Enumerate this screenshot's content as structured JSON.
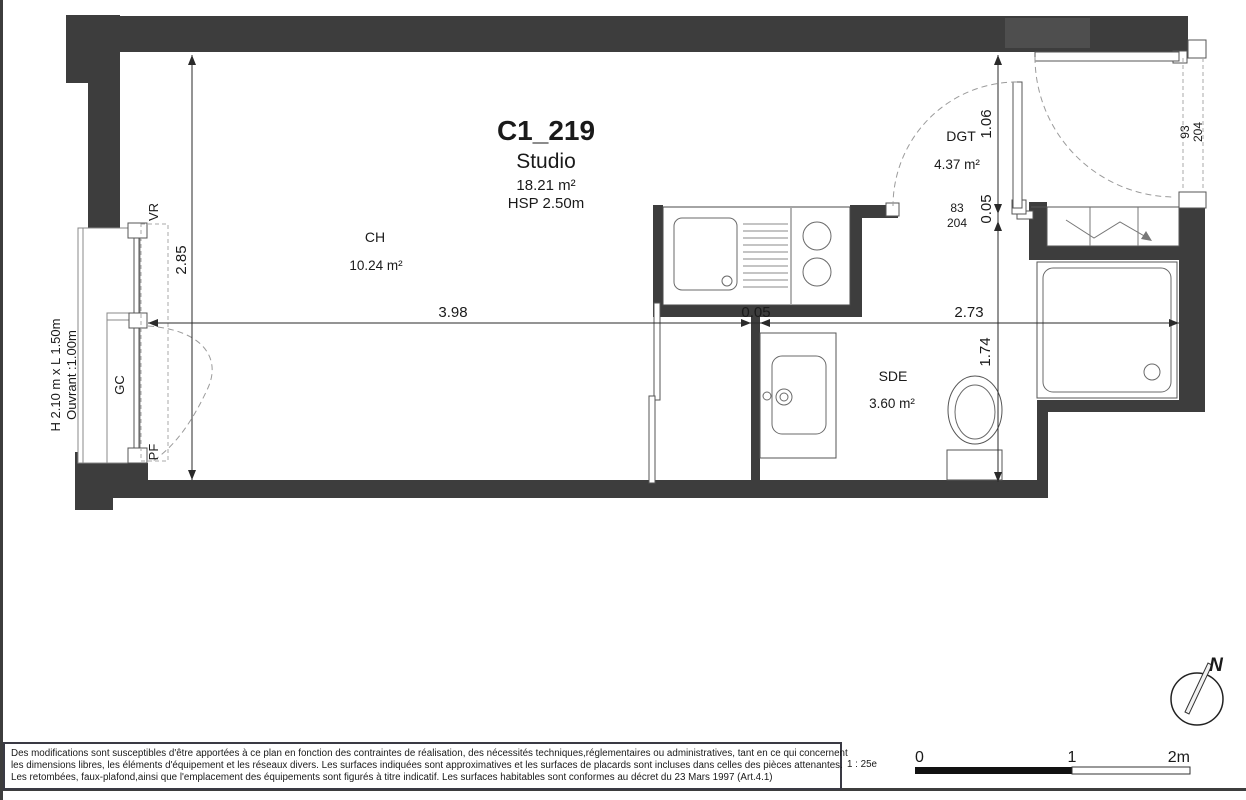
{
  "colors": {
    "wall": "#3d3d3d",
    "furniture_line": "#555555",
    "dashed_line": "#9b9b9b",
    "text": "#1a1a1a",
    "frame": "#3a3a44"
  },
  "title_block": {
    "unit": "C1_219",
    "type": "Studio",
    "area": "18.21 m²",
    "ceiling": "HSP 2.50m"
  },
  "rooms": {
    "ch": {
      "code": "CH",
      "area": "10.24 m²"
    },
    "dgt": {
      "code": "DGT",
      "area": "4.37 m²"
    },
    "sde": {
      "code": "SDE",
      "area": "3.60 m²"
    }
  },
  "dimensions": {
    "room_height": "2.85",
    "ch_width": "3.98",
    "partition_thickness": "0.05",
    "right_width": "2.73",
    "dgt_depth": "1.06",
    "dgt_wall_thickness": "0.05",
    "sde_depth": "1.74"
  },
  "doors": {
    "dgt_width": "83",
    "dgt_height": "204",
    "entry_width": "93",
    "entry_height": "204"
  },
  "window": {
    "size": "H 2.10 m x L 1.50m",
    "opening": "Ouvrant :1.00m",
    "shutter": "VR",
    "guardrail": "GC",
    "french_door": "PF"
  },
  "footer": {
    "disclaimer": [
      "Des modifications sont susceptibles d'être apportées à ce plan en fonction des contraintes de réalisation, des nécessités techniques,réglementaires ou administratives, tant en ce qui concernent",
      "les dimensions libres, les éléments d'équipement et les réseaux divers. Les surfaces indiquées sont approximatives et les surfaces de placards sont incluses dans celles des pièces attenantes.",
      "Les retombées, faux-plafond,ainsi que l'emplacement des équipements sont figurés à titre indicatif. Les surfaces habitables sont conformes au décret du 23 Mars 1997 (Art.4.1)"
    ],
    "scale_text": "1 : 25e",
    "scale_bar": {
      "t0": "0",
      "t1": "1",
      "t2": "2m"
    }
  },
  "compass": {
    "north": "N"
  }
}
